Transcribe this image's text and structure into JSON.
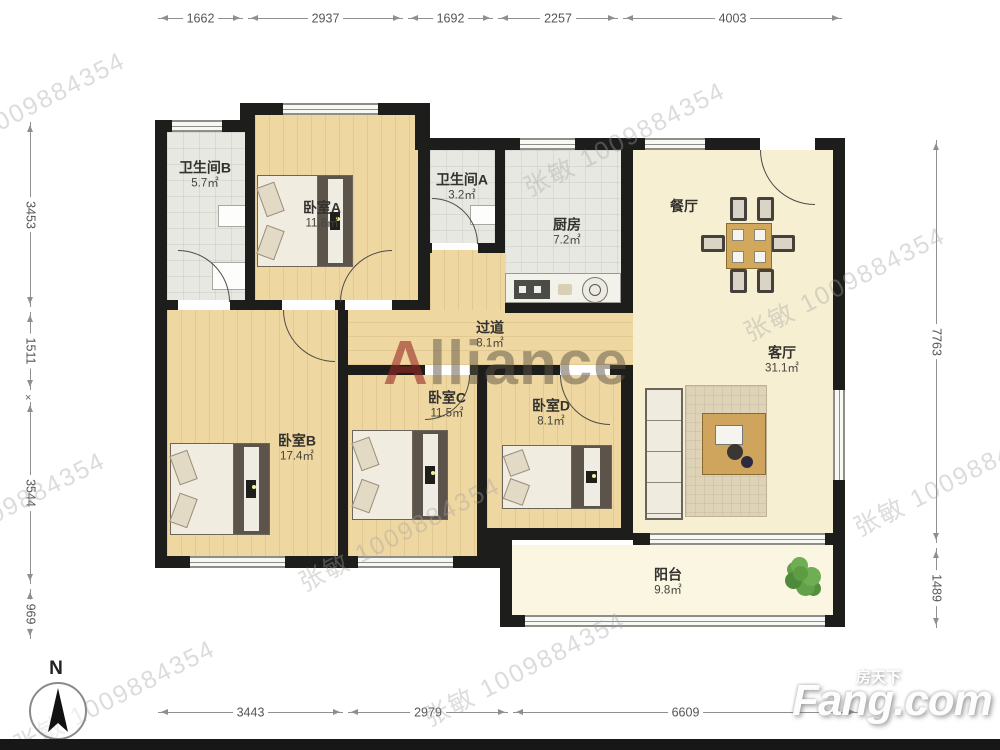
{
  "plan": {
    "rooms": [
      {
        "name": "卫生间B",
        "area": "5.7㎡"
      },
      {
        "name": "卧室A",
        "area": "11.8㎡"
      },
      {
        "name": "卫生间A",
        "area": "3.2㎡"
      },
      {
        "name": "厨房",
        "area": "7.2㎡"
      },
      {
        "name": "餐厅",
        "area": ""
      },
      {
        "name": "客厅",
        "area": "31.1㎡"
      },
      {
        "name": "过道",
        "area": "8.1㎡"
      },
      {
        "name": "卧室B",
        "area": "17.4㎡"
      },
      {
        "name": "卧室C",
        "area": "11.5㎡"
      },
      {
        "name": "卧室D",
        "area": "8.1㎡"
      },
      {
        "name": "阳台",
        "area": "9.8㎡"
      }
    ]
  },
  "dimensions": {
    "top": [
      "1662",
      "2937",
      "1692",
      "2257",
      "4003"
    ],
    "left": [
      "3453",
      "1511",
      "3544",
      "969"
    ],
    "left_marker": "×",
    "right": [
      "7763",
      "1489"
    ],
    "bottom": [
      "3443",
      "2979",
      "6609"
    ]
  },
  "watermark": {
    "agent": "张敏 1009884354",
    "brand_initial": "A",
    "brand_rest": "lliance"
  },
  "compass": {
    "label": "N"
  },
  "logo": {
    "cn": "房天下",
    "en": "Fang.com"
  },
  "colors": {
    "wood": "#eed7a1",
    "tile": "#e8e8e2",
    "cream": "#f6efd2",
    "wall": "#1d1d1b",
    "dim_line": "#8f8f8f",
    "brand_red": "#982a24",
    "plant_green": "#5e9c44"
  }
}
